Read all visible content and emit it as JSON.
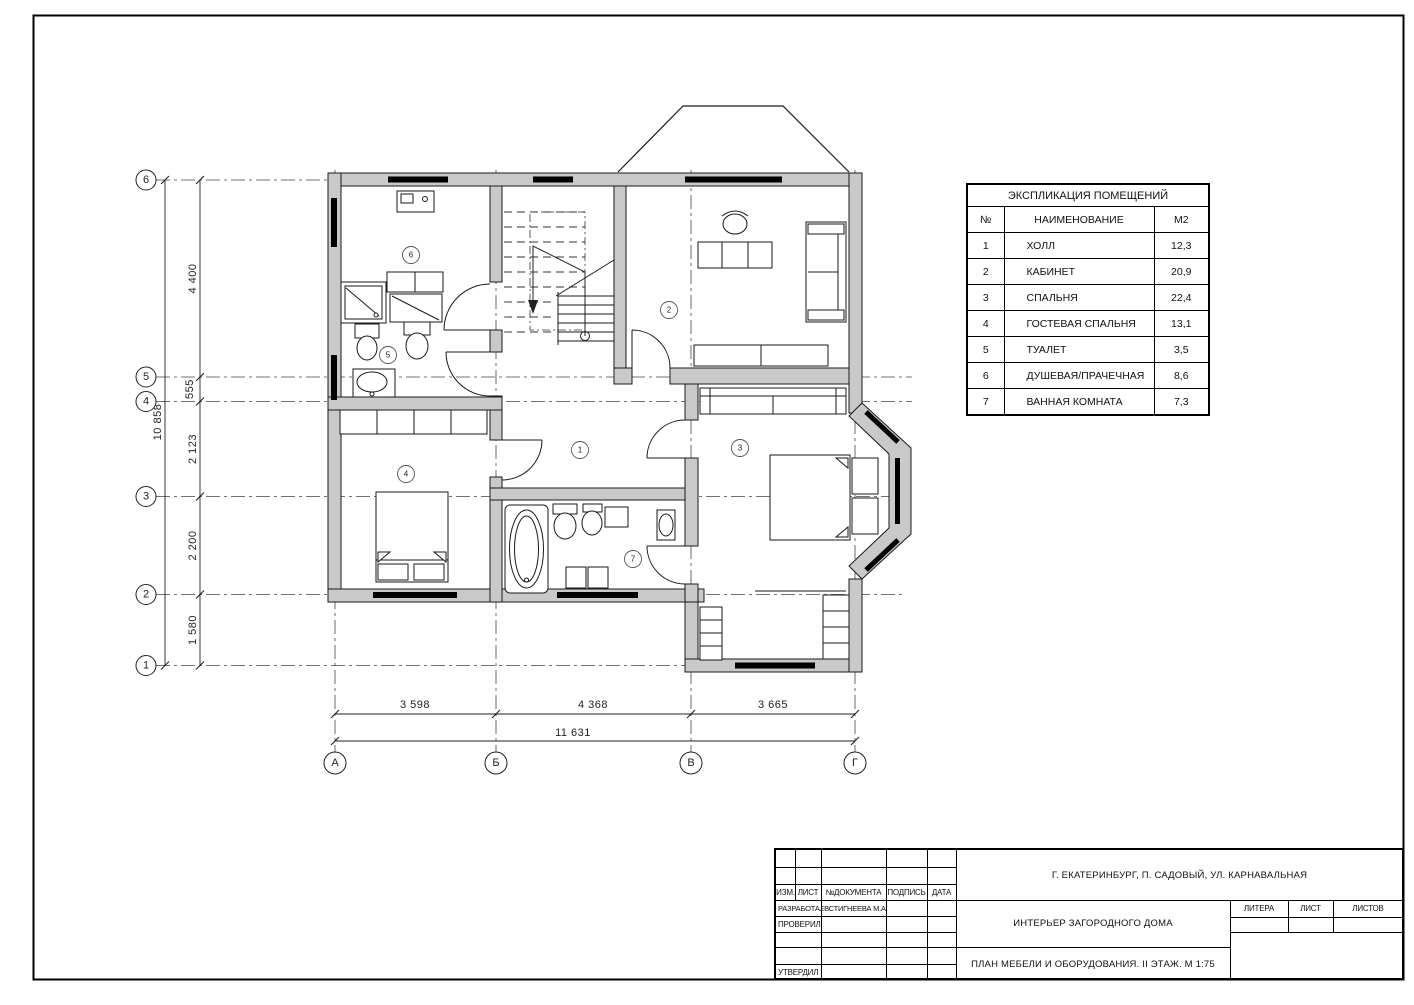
{
  "colors": {
    "wall_fill": "#c9c9c9",
    "line": "#1a1a1a",
    "window": "#000000"
  },
  "plan": {
    "axes_vertical": [
      "6",
      "5",
      "4",
      "3",
      "2",
      "1"
    ],
    "axes_horizontal": [
      "А",
      "Б",
      "В",
      "Г"
    ],
    "dims_left": [
      "4 400",
      "555",
      "2 123",
      "2 200",
      "1 580"
    ],
    "dim_left_total": "10 858",
    "dims_bottom": [
      "3 598",
      "4 368",
      "3 665"
    ],
    "dim_bottom_total": "11 631",
    "room_numbers": [
      "1",
      "2",
      "3",
      "4",
      "5",
      "6",
      "7"
    ]
  },
  "explication": {
    "title": "ЭКСПЛИКАЦИЯ ПОМЕЩЕНИЙ",
    "columns": {
      "num": "№",
      "name": "НАИМЕНОВАНИЕ",
      "area": "М2"
    },
    "rows": [
      {
        "num": "1",
        "name": "ХОЛЛ",
        "area": "12,3"
      },
      {
        "num": "2",
        "name": "КАБИНЕТ",
        "area": "20,9"
      },
      {
        "num": "3",
        "name": "СПАЛЬНЯ",
        "area": "22,4"
      },
      {
        "num": "4",
        "name": "ГОСТЕВАЯ СПАЛЬНЯ",
        "area": "13,1"
      },
      {
        "num": "5",
        "name": "ТУАЛЕТ",
        "area": "3,5"
      },
      {
        "num": "6",
        "name": "ДУШЕВАЯ/ПРАЧЕЧНАЯ",
        "area": "8,6"
      },
      {
        "num": "7",
        "name": "ВАННАЯ КОМНАТА",
        "area": "7,3"
      }
    ]
  },
  "title_block": {
    "labels": {
      "izm": "ИЗМ.",
      "list": "ЛИСТ",
      "doc": "№ДОКУМЕНТА",
      "podpis": "ПОДПИСЬ",
      "data": "ДАТА",
      "razrabotal": "РАЗРАБОТАЛ",
      "proveril": "ПРОВЕРИЛ",
      "utverdil": "УТВЕРДИЛ",
      "litera": "ЛИТЕРА",
      "list2": "ЛИСТ",
      "listov": "ЛИСТОВ"
    },
    "developer": "ЕВСТИГНЕЕВА М.А.",
    "address": "Г. ЕКАТЕРИНБУРГ, П. САДОВЫЙ, УЛ. КАРНАВАЛЬНАЯ",
    "project": "ИНТЕРЬЕР ЗАГОРОДНОГО ДОМА",
    "sheet_title": "ПЛАН МЕБЕЛИ И ОБОРУДОВАНИЯ. II ЭТАЖ. М 1:75"
  }
}
